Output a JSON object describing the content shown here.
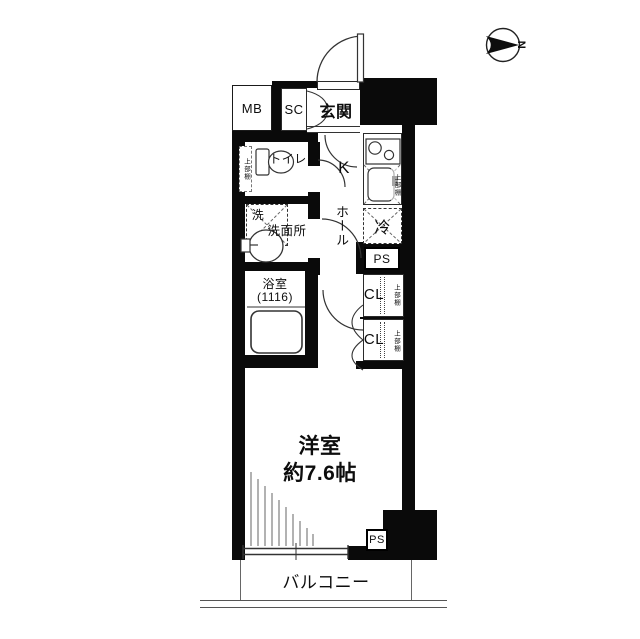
{
  "compass": {
    "label": "N"
  },
  "rooms": {
    "meter_box": "MB",
    "shoe_closet": "SC",
    "entrance": "玄関",
    "toilet": "トイレ",
    "kitchen": "K",
    "hall": "ホール",
    "washer": "洗",
    "washroom": "洗面所",
    "fridge": "冷",
    "pipe_space_top": "PS",
    "bathroom": "浴室",
    "bathroom_size": "(1116)",
    "closet_upper": "CL",
    "closet_lower": "CL",
    "shelf": "上部棚",
    "main_room_name": "洋室",
    "main_room_size": "約7.6帖",
    "pipe_space_bottom": "PS",
    "balcony": "バルコニー"
  },
  "colors": {
    "wall": "#0a0a0a",
    "line": "#333333",
    "background": "#ffffff"
  }
}
